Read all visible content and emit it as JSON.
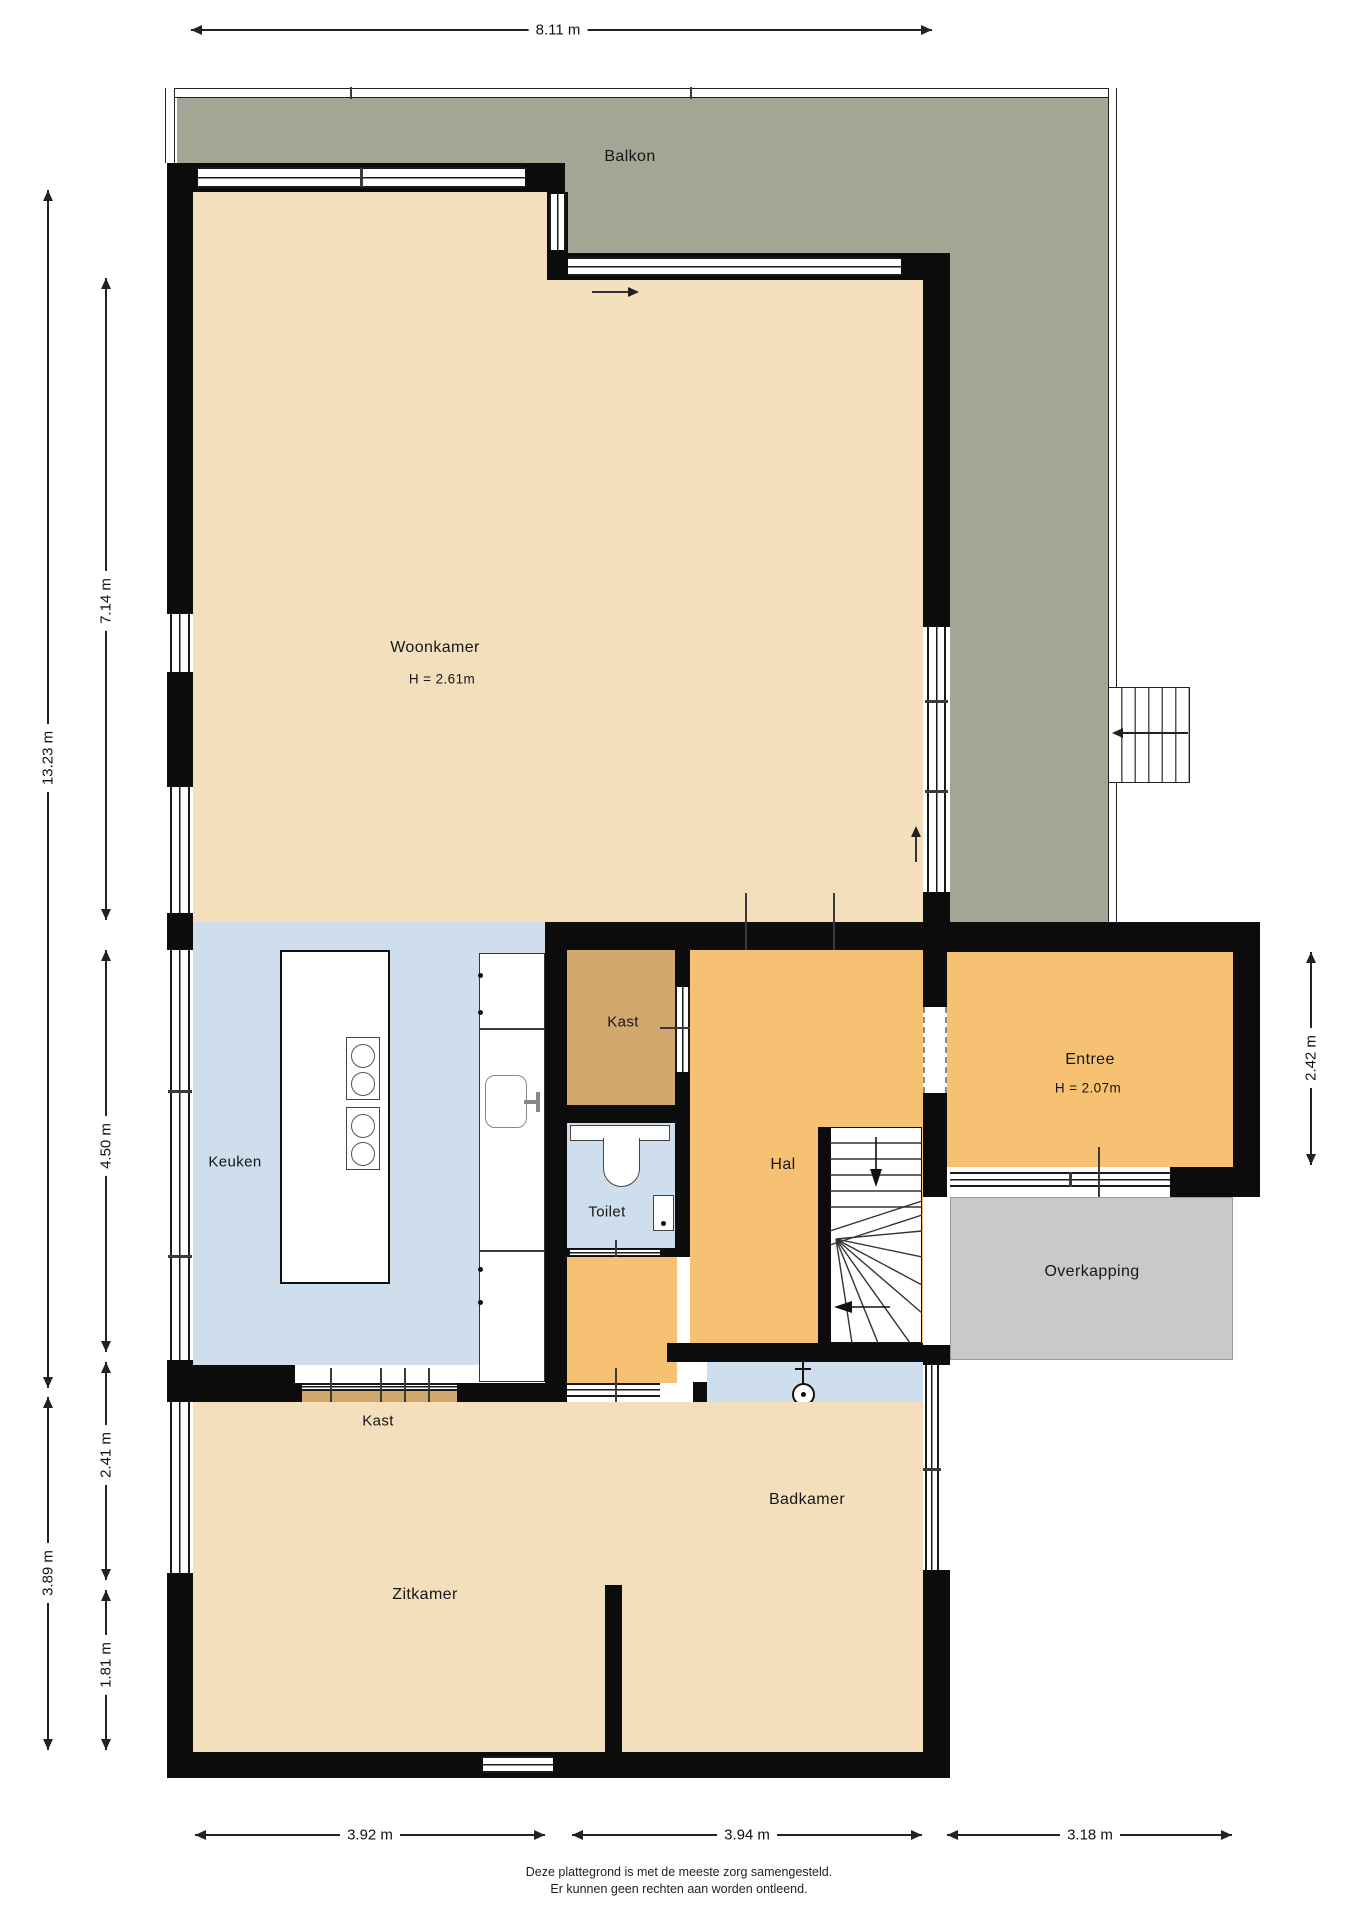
{
  "title": "Plattegrond begane grond / verdieping",
  "colors": {
    "beige": "#f3dfbc",
    "blue": "#cfdeed",
    "orange": "#f7c173",
    "tan": "#d2a86e",
    "balkon": "#a3a595",
    "overkap": "#c9c9c9",
    "wall": "#0c0c0c",
    "line": "#1a1a1a"
  },
  "rooms": {
    "balkon": {
      "label": "Balkon"
    },
    "woonkamer": {
      "label": "Woonkamer",
      "height": "H = 2.61m"
    },
    "keuken": {
      "label": "Keuken"
    },
    "kast_boven": {
      "label": "Kast"
    },
    "toilet": {
      "label": "Toilet"
    },
    "hal": {
      "label": "Hal"
    },
    "entree": {
      "label": "Entree",
      "height": "H = 2.07m"
    },
    "overkapping": {
      "label": "Overkapping"
    },
    "badkamer": {
      "label": "Badkamer"
    },
    "kast_onder": {
      "label": "Kast"
    },
    "zitkamer": {
      "label": "Zitkamer"
    }
  },
  "dimensions": {
    "top_width": "8.11 m",
    "left_total": "13.23 m",
    "woonkamer_height": "7.14 m",
    "keuken_height": "4.50 m",
    "zitkamer_upper": "2.41 m",
    "zitkamer_total": "3.89 m",
    "zitkamer_lower": "1.81 m",
    "entree_height": "2.42 m",
    "bottom_left": "3.92 m",
    "bottom_middle": "3.94 m",
    "bottom_right": "3.18 m"
  },
  "footer": {
    "line1": "Deze plattegrond is met de meeste zorg samengesteld.",
    "line2": "Er kunnen geen rechten aan worden ontleend."
  }
}
